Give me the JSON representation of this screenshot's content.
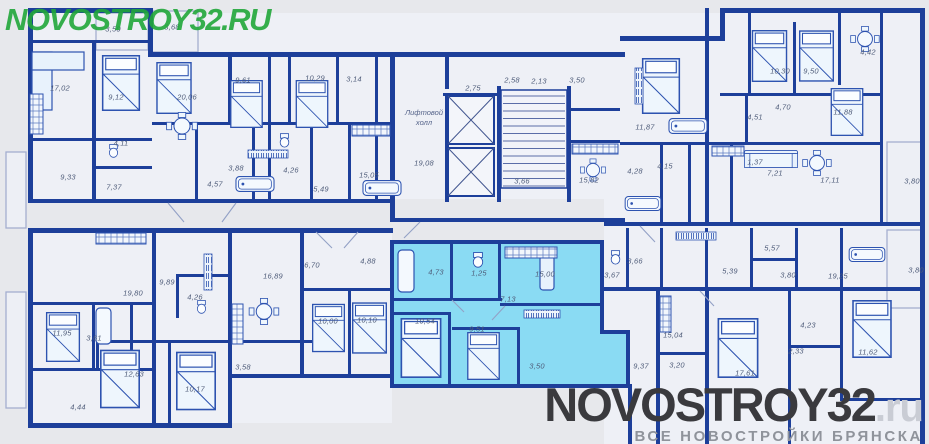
{
  "watermarks": {
    "top_left": "NOVOSTROY32.RU",
    "bottom_brand": "NOVOSTROY32",
    "bottom_brand_suffix": ".ru",
    "bottom_tagline": "ВСЕ НОВОСТРОЙКИ БРЯНСКА"
  },
  "colors": {
    "wall": "#1d3f9a",
    "highlight": "#8adbf3",
    "background": "#e7e8ec",
    "label": "#4f5c79",
    "brand_green": "#21a73a",
    "logo_dark": "#3a3a3e",
    "logo_gray": "#8f939b"
  },
  "lift_hall": {
    "line1": "Лифтовой",
    "line2": "холл"
  },
  "rooms": [
    {
      "a": "17,02",
      "x": 60,
      "y": 88
    },
    {
      "a": "3,50",
      "x": 113,
      "y": 29
    },
    {
      "a": "9,12",
      "x": 116,
      "y": 97
    },
    {
      "a": "3,68",
      "x": 172,
      "y": 27
    },
    {
      "a": "20,06",
      "x": 187,
      "y": 97
    },
    {
      "a": "4,11",
      "x": 121,
      "y": 143
    },
    {
      "a": "9,33",
      "x": 68,
      "y": 177
    },
    {
      "a": "7,37",
      "x": 114,
      "y": 187
    },
    {
      "a": "9,61",
      "x": 243,
      "y": 80
    },
    {
      "a": "10,29",
      "x": 315,
      "y": 78
    },
    {
      "a": "3,14",
      "x": 354,
      "y": 79
    },
    {
      "a": "4,57",
      "x": 215,
      "y": 184
    },
    {
      "a": "3,88",
      "x": 236,
      "y": 168
    },
    {
      "a": "4,26",
      "x": 291,
      "y": 170
    },
    {
      "a": "5,49",
      "x": 321,
      "y": 189
    },
    {
      "a": "15,05",
      "x": 369,
      "y": 175
    },
    {
      "a": "2,75",
      "x": 473,
      "y": 88
    },
    {
      "a": "2,58",
      "x": 512,
      "y": 80
    },
    {
      "a": "2,13",
      "x": 539,
      "y": 81
    },
    {
      "a": "19,08",
      "x": 424,
      "y": 163
    },
    {
      "a": "3,66",
      "x": 522,
      "y": 181
    },
    {
      "a": "3,50",
      "x": 577,
      "y": 80
    },
    {
      "a": "15,82",
      "x": 589,
      "y": 180
    },
    {
      "a": "11,87",
      "x": 645,
      "y": 127
    },
    {
      "a": "10,30",
      "x": 780,
      "y": 71
    },
    {
      "a": "9,50",
      "x": 811,
      "y": 71
    },
    {
      "a": "4,42",
      "x": 868,
      "y": 52
    },
    {
      "a": "4,51",
      "x": 755,
      "y": 117
    },
    {
      "a": "4,70",
      "x": 783,
      "y": 107
    },
    {
      "a": "11,88",
      "x": 843,
      "y": 112
    },
    {
      "a": "4,28",
      "x": 635,
      "y": 171
    },
    {
      "a": "4,15",
      "x": 665,
      "y": 166
    },
    {
      "a": "1,37",
      "x": 755,
      "y": 162
    },
    {
      "a": "7,21",
      "x": 775,
      "y": 173
    },
    {
      "a": "17,11",
      "x": 830,
      "y": 180
    },
    {
      "a": "3,80",
      "x": 912,
      "y": 181
    },
    {
      "a": "5,57",
      "x": 772,
      "y": 248
    },
    {
      "a": "3,66",
      "x": 635,
      "y": 261
    },
    {
      "a": "5,39",
      "x": 730,
      "y": 271
    },
    {
      "a": "3,80",
      "x": 788,
      "y": 275
    },
    {
      "a": "19,25",
      "x": 838,
      "y": 276
    },
    {
      "a": "3,80",
      "x": 916,
      "y": 270
    },
    {
      "a": "19,80",
      "x": 133,
      "y": 293
    },
    {
      "a": "9,89",
      "x": 167,
      "y": 282
    },
    {
      "a": "4,26",
      "x": 195,
      "y": 297
    },
    {
      "a": "16,89",
      "x": 273,
      "y": 276
    },
    {
      "a": "6,70",
      "x": 312,
      "y": 265
    },
    {
      "a": "4,88",
      "x": 368,
      "y": 261
    },
    {
      "a": "11,95",
      "x": 62,
      "y": 333
    },
    {
      "a": "3,61",
      "x": 94,
      "y": 338
    },
    {
      "a": "4,44",
      "x": 78,
      "y": 407
    },
    {
      "a": "12,63",
      "x": 134,
      "y": 374
    },
    {
      "a": "10,17",
      "x": 195,
      "y": 389
    },
    {
      "a": "3,58",
      "x": 243,
      "y": 367
    },
    {
      "a": "10,00",
      "x": 328,
      "y": 321
    },
    {
      "a": "10,10",
      "x": 367,
      "y": 320
    },
    {
      "a": "4,73",
      "x": 436,
      "y": 272,
      "hl": true
    },
    {
      "a": "1,25",
      "x": 479,
      "y": 273,
      "hl": true
    },
    {
      "a": "15,00",
      "x": 545,
      "y": 274,
      "hl": true
    },
    {
      "a": "7,13",
      "x": 508,
      "y": 299,
      "hl": true
    },
    {
      "a": "10,54",
      "x": 425,
      "y": 321,
      "hl": true
    },
    {
      "a": "9,51",
      "x": 477,
      "y": 329,
      "hl": true
    },
    {
      "a": "3,50",
      "x": 537,
      "y": 366,
      "hl": true
    },
    {
      "a": "3,67",
      "x": 612,
      "y": 275
    },
    {
      "a": "9,37",
      "x": 641,
      "y": 366
    },
    {
      "a": "15,04",
      "x": 673,
      "y": 335
    },
    {
      "a": "3,20",
      "x": 677,
      "y": 365
    },
    {
      "a": "17,61",
      "x": 745,
      "y": 373
    },
    {
      "a": "4,23",
      "x": 808,
      "y": 325
    },
    {
      "a": "2,33",
      "x": 796,
      "y": 351
    },
    {
      "a": "11,62",
      "x": 868,
      "y": 352
    }
  ]
}
